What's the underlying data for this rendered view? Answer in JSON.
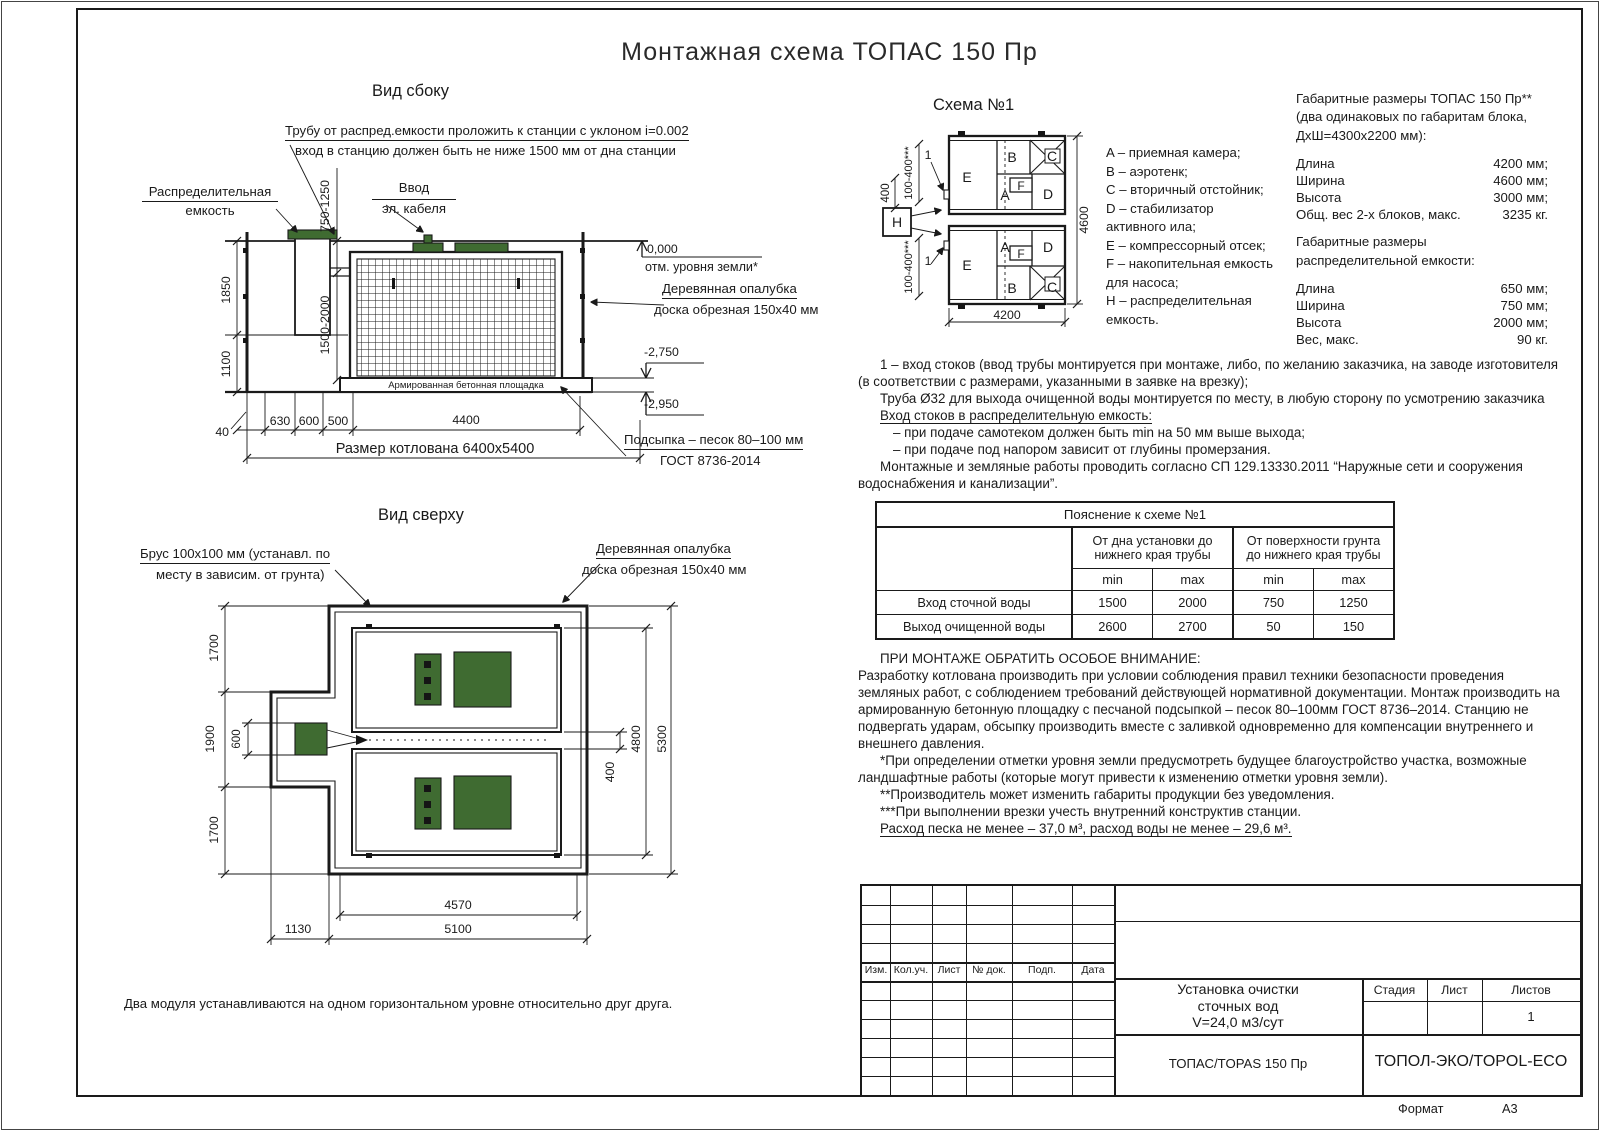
{
  "title": "Монтажная схема ТОПАС 150 Пр",
  "side_view": {
    "heading": "Вид сбоку",
    "note_pipe1": "Трубу от распред.емкости проложить к станции с уклоном i=0.002",
    "note_pipe2": "вход в станцию должен быть не ниже 1500 мм от дна станции",
    "dist_tank1": "Распределительная",
    "dist_tank2": "емкость",
    "cable1": "Ввод",
    "cable2": "эл. кабеля",
    "elev_zero": "0,000",
    "elev_zero_label": "отм. уровня земли*",
    "formwork1": "Деревянная опалубка",
    "formwork2": "доска обрезная 150х40 мм",
    "elev_2750": "-2,750",
    "elev_2950": "-2,950",
    "pad_label": "Армированная бетонная площадка",
    "bedding1": "Подсыпка – песок 80–100 мм",
    "bedding2": "ГОСТ 8736-2014",
    "dims": {
      "d1850": "1850",
      "d1100": "1100",
      "d750": "750-1250",
      "d1500": "1500-2000",
      "d40": "40",
      "d630": "630",
      "d600": "600",
      "d500": "500",
      "d4400": "4400",
      "pit": "Размер котлована 6400х5400"
    }
  },
  "top_view": {
    "heading": "Вид сверху",
    "beam1": "Брус 100х100 мм (устанавл. по",
    "beam2": "месту в зависим. от грунта)",
    "formwork1": "Деревянная опалубка",
    "formwork2": "доска обрезная 150х40 мм",
    "dims": {
      "d1700t": "1700",
      "d1900": "1900",
      "d600": "600",
      "d1700b": "1700",
      "d400": "400",
      "d4800": "4800",
      "d5300": "5300",
      "d4570": "4570",
      "d5100": "5100",
      "d1130": "1130"
    },
    "footnote": "Два модуля устанавлива­ются на одном горизонтальном уровне относительно друг друга."
  },
  "scheme": {
    "heading": "Схема №1",
    "labels": {
      "A": "A",
      "B": "B",
      "C": "C",
      "D": "D",
      "E": "E",
      "F": "F",
      "H": "H",
      "n1": "1"
    },
    "dims": {
      "d4200": "4200",
      "d4600": "4600",
      "d400": "400",
      "d100t": "100-400***",
      "d100b": "100-400***"
    }
  },
  "legend": {
    "lines": [
      "A – приемная камера;",
      "B – аэротенк;",
      "C – вторичный отстойник;",
      "D – стабилизатор",
      "активного ила;",
      "E – компрессорный отсек;",
      "F – накопительная емкость",
      "для насоса;",
      "H – распределительная",
      "емкость."
    ]
  },
  "overall": {
    "title1": "Габаритные размеры ТОПАС 150 Пр**",
    "title2": "(два одинаковых по габаритам блока,",
    "title3": "ДхШ=4300х2200 мм):",
    "station_rows": [
      [
        "Длина",
        "4200 мм;"
      ],
      [
        "Ширина",
        "4600 мм;"
      ],
      [
        "Высота",
        "3000 мм;"
      ],
      [
        "Общ. вес 2-х блоков, макс.",
        "3235 кг."
      ]
    ],
    "tank_title1": "Габаритные размеры",
    "tank_title2": "распределительной емкости:",
    "tank_rows": [
      [
        "Длина",
        "650 мм;"
      ],
      [
        "Ширина",
        "750 мм;"
      ],
      [
        "Высота",
        "2000 мм;"
      ],
      [
        "Вес, макс.",
        "90 кг."
      ]
    ]
  },
  "notes": {
    "para1": "1 – вход  стоков (ввод трубы монтируется при монтаже, либо, по желанию заказчика, на заводе изготовителя (в соответствии с размерами, указанными в заявке на врезку);",
    "para2": "Труба Ø32 для выхода очищенной воды монтируется по месту, в любую сторону по усмотрению заказчика",
    "inlet_heading": "Вход стоков в распределительную емкость:",
    "inlet_item1": "– при подаче самотеком должен быть min на 50 мм выше выхода;",
    "inlet_item2": "– при подаче под напором зависит от глубины промерзания.",
    "para3": "Монтажные и земляные работы проводить согласно СП 129.13330.2011 “Наружные сети и сооружения водоснабжения и канализации”."
  },
  "table": {
    "title": "Пояснение к схеме №1",
    "group1": "От дна установки до нижнего края трубы",
    "group2": "От поверхности грунта до нижнего края трубы",
    "min1": "min",
    "max1": "max",
    "min2": "min",
    "max2": "max",
    "rows": [
      [
        "Вход сточной воды",
        "1500",
        "2000",
        "750",
        "1250"
      ],
      [
        "Выход очищенной воды",
        "2600",
        "2700",
        "50",
        "150"
      ]
    ]
  },
  "attention": {
    "heading": "ПРИ МОНТАЖЕ ОБРАТИТЬ ОСОБОЕ ВНИМАНИЕ:",
    "body": "Разработку котлована производить при условии соблюдения правил техники безопасности проведения земляных работ, с соблюдением требований действующей нормативной документации.  Монтаж производить на армированную бетонную площадку с песчаной подсыпкой – песок 80–100мм ГОСТ 8736–2014. Станцию не подвергать ударам, обсыпку производить вместе с заливкой одновременно для компенсации внутреннего и внешнего давления.",
    "fn1": "*При определении отметки уровня земли предусмотреть будущее благоустройство участка, возможные ландшафтные работы (которые могут привести к изменению отметки уровня земли).",
    "fn2": "**Производитель может изменить габариты продукции без уведомления.",
    "fn3": "***При выполнении врезки учесть внутренний конструктив станции.",
    "consumption": "Расход песка не менее – 37,0 м³, расход воды не менее – 29,6 м³."
  },
  "title_block": {
    "rev_headers": [
      "Изм.",
      "Кол.уч.",
      "Лист",
      "№ док.",
      "Подп.",
      "Дата"
    ],
    "doc_title1": "Установка очистки",
    "doc_title2": "сточных вод",
    "doc_title3": "V=24,0 м3/сут",
    "stage_label": "Стадия",
    "sheet_label": "Лист",
    "sheets_label": "Листов",
    "sheets_value": "1",
    "product": "ТОПАС/TOPAS 150 Пр",
    "company": "ТОПОЛ-ЭКО/TOPOL-ECO",
    "format_label": "Формат",
    "format_value": "А3"
  },
  "colors": {
    "line": "#1a1a1a",
    "green": "#3f6b31"
  }
}
